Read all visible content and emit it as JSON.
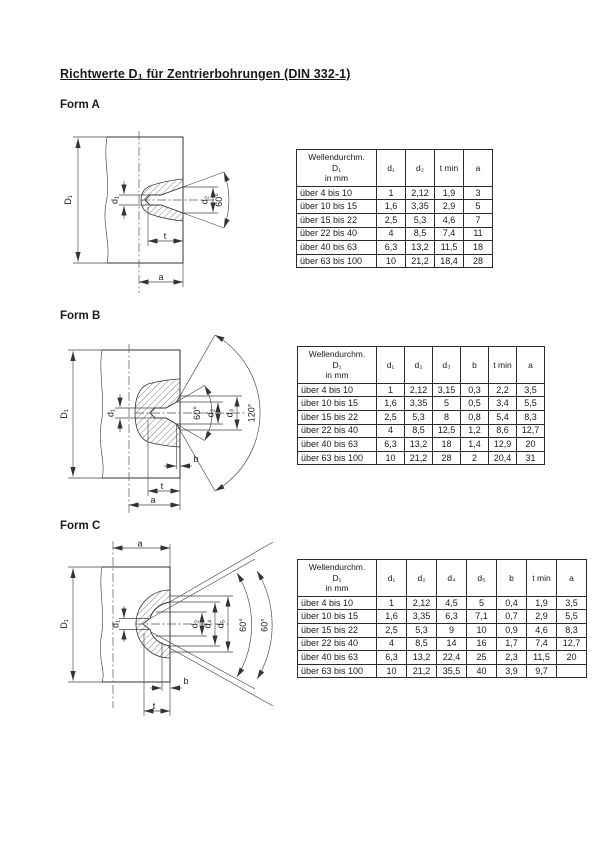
{
  "page": {
    "title": "Richtwerte D₁ für Zentrierbohrungen (DIN 332-1)"
  },
  "forms": [
    {
      "heading": "Form A",
      "drawing": {
        "D1": "D₁",
        "d1": "d₁",
        "d2": "d₂",
        "angle": "60°",
        "t": "t",
        "a": "a"
      },
      "table": {
        "header": [
          "Wellendurchm.\nD₁\nin mm",
          "d₁",
          "d₂",
          "t min",
          "a"
        ],
        "rows": [
          [
            "über 4 bis 10",
            "1",
            "2,12",
            "1,9",
            "3"
          ],
          [
            "über 10 bis 15",
            "1,6",
            "3,35",
            "2,9",
            "5"
          ],
          [
            "über 15 bis 22",
            "2,5",
            "5,3",
            "4,6",
            "7"
          ],
          [
            "über 22 bis 40",
            "4",
            "8,5",
            "7,4",
            "11"
          ],
          [
            "über 40 bis 63",
            "6,3",
            "13,2",
            "11,5",
            "18"
          ],
          [
            "über 63 bis 100",
            "10",
            "21,2",
            "18,4",
            "28"
          ]
        ]
      }
    },
    {
      "heading": "Form B",
      "drawing": {
        "D1": "D₁",
        "d1": "d₁",
        "d2": "d₂",
        "d3": "d₃",
        "angle60": "60°",
        "angle120": "120°",
        "b": "b",
        "t": "t",
        "a": "a"
      },
      "table": {
        "header": [
          "Wellendurchm.\nD₁\nin mm",
          "d₁",
          "d₂",
          "d₃",
          "b",
          "t min",
          "a"
        ],
        "rows": [
          [
            "über 4 bis 10",
            "1",
            "2,12",
            "3,15",
            "0,3",
            "2,2",
            "3,5"
          ],
          [
            "über 10 bis 15",
            "1,6",
            "3,35",
            "5",
            "0,5",
            "3,4",
            "5,5"
          ],
          [
            "über 15 bis 22",
            "2,5",
            "5,3",
            "8",
            "0,8",
            "5,4",
            "8,3"
          ],
          [
            "über 22 bis 40",
            "4",
            "8,5",
            "12,5",
            "1,2",
            "8,6",
            "12,7"
          ],
          [
            "über 40 bis 63",
            "6,3",
            "13,2",
            "18",
            "1,4",
            "12,9",
            "20"
          ],
          [
            "über 63 bis 100",
            "10",
            "21,2",
            "28",
            "2",
            "20,4",
            "31"
          ]
        ]
      }
    },
    {
      "heading": "Form C",
      "drawing": {
        "D1": "D₁",
        "d1": "d₁",
        "d2": "d₂",
        "d4": "d₄",
        "d5": "d₅",
        "angle60a": "60°",
        "angle60b": "60°",
        "b": "b",
        "t": "t",
        "a": "a"
      },
      "table": {
        "header": [
          "Wellendurchm.\nD₁\nin mm",
          "d₁",
          "d₂",
          "d₄",
          "d₅",
          "b",
          "t min",
          "a"
        ],
        "rows": [
          [
            "über 4 bis 10",
            "1",
            "2,12",
            "4,5",
            "5",
            "0,4",
            "1,9",
            "3,5"
          ],
          [
            "über 10 bis 15",
            "1,6",
            "3,35",
            "6,3",
            "7,1",
            "0,7",
            "2,9",
            "5,5"
          ],
          [
            "über 15 bis 22",
            "2,5",
            "5,3",
            "9",
            "10",
            "0,9",
            "4,6",
            "8,3"
          ],
          [
            "über 22 bis 40",
            "4",
            "8,5",
            "14",
            "16",
            "1,7",
            "7,4",
            "12,7"
          ],
          [
            "über 40 bis 63",
            "6,3",
            "13,2",
            "22,4",
            "25",
            "2,3",
            "11,5",
            "20"
          ],
          [
            "über 63 bis 100",
            "10",
            "21,2",
            "35,5",
            "40",
            "3,9",
            "9,7",
            ""
          ]
        ]
      }
    }
  ]
}
